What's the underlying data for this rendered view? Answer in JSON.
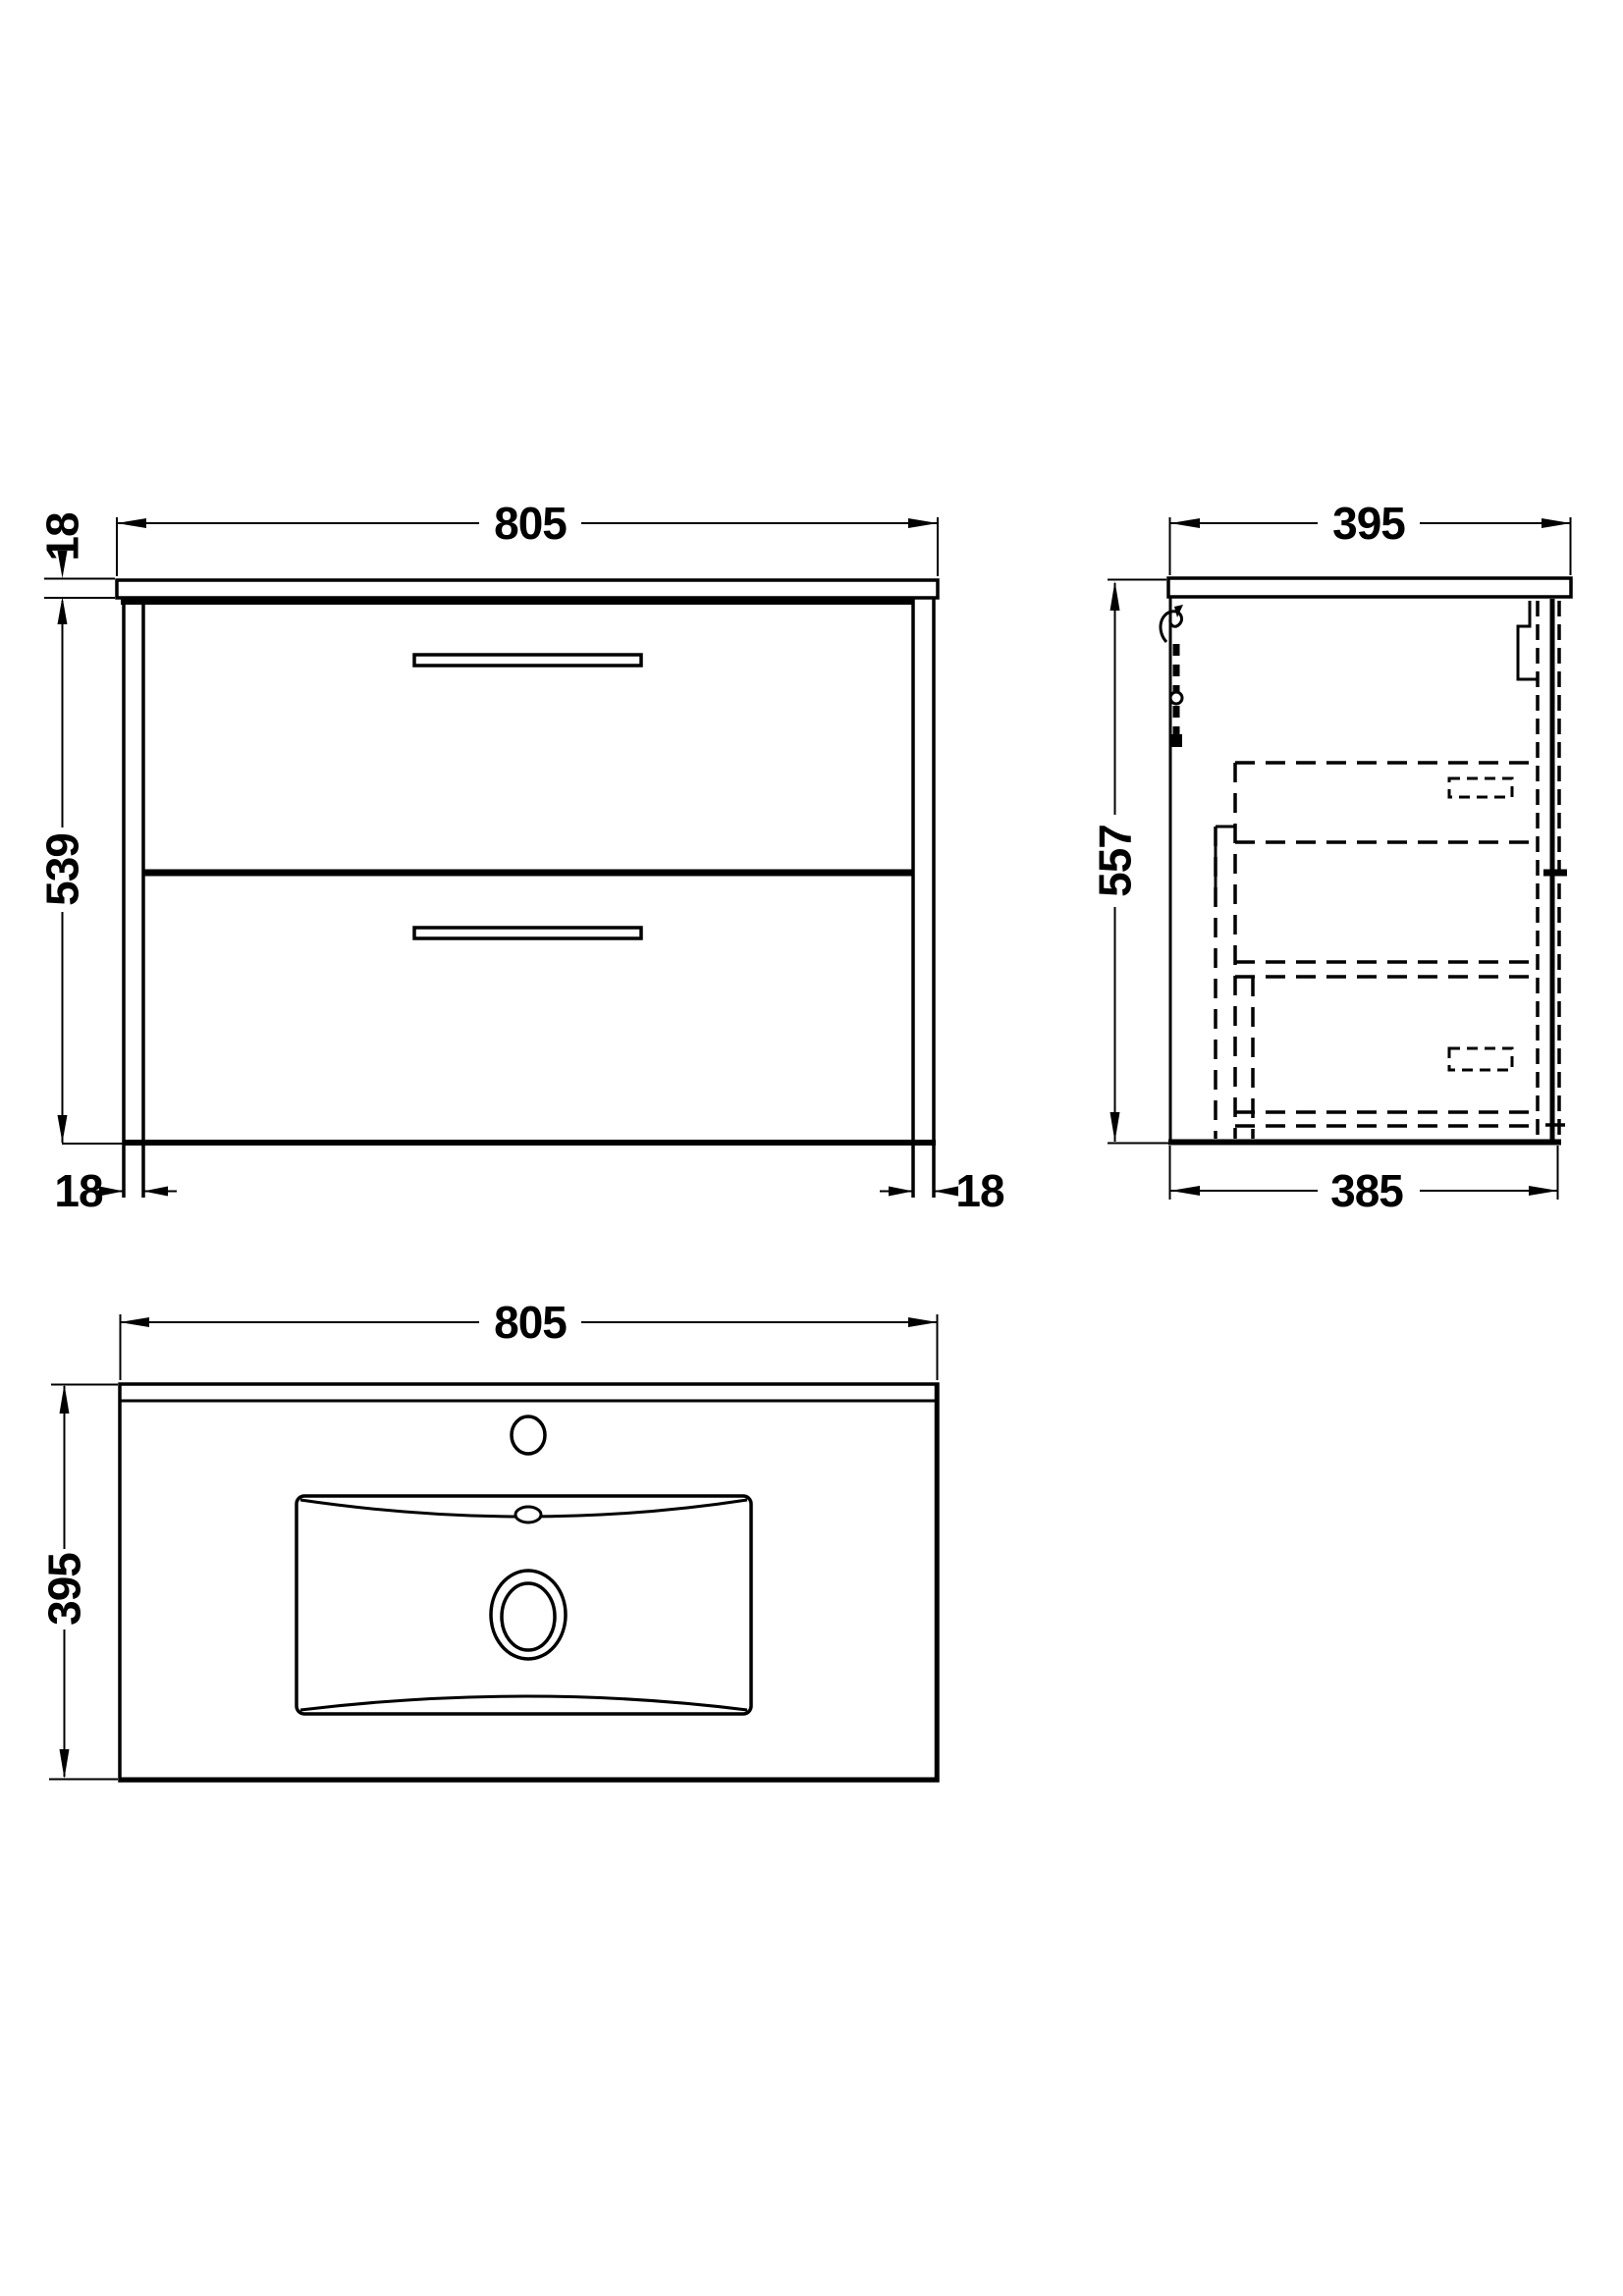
{
  "drawing_type": "bathroom vanity unit technical drawing, three orthographic views",
  "colors": {
    "line": "#000000",
    "background": "#ffffff"
  },
  "views": {
    "front": {
      "name": "front elevation",
      "width": "805",
      "counter_thickness": "18",
      "cabinet_height": "539",
      "left_panel_thickness": "18",
      "right_panel_thickness": "18",
      "drawer_count": 2
    },
    "side": {
      "name": "side elevation",
      "counter_depth": "395",
      "overall_height": "557",
      "cabinet_depth": "385"
    },
    "plan": {
      "name": "plan view with basin",
      "width": "805",
      "depth": "395"
    }
  }
}
